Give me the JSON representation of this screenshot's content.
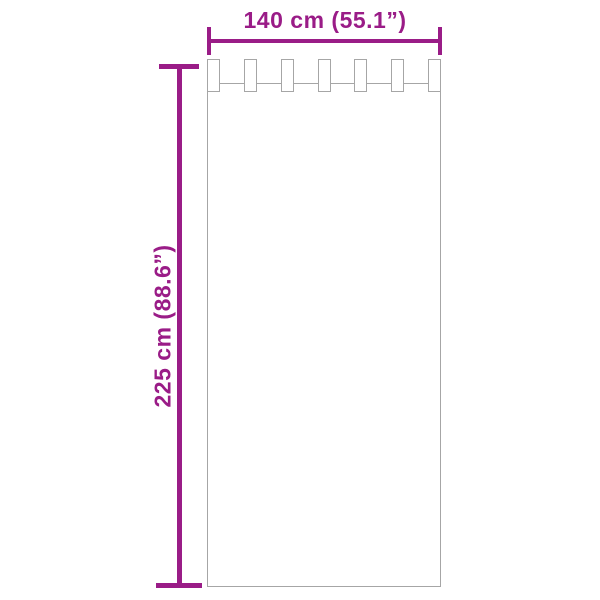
{
  "diagram": {
    "width_label": "140 cm (55.1”)",
    "height_label": "225 cm (88.6”)",
    "tab_count": 7,
    "colors": {
      "dimension": "#9A1C87",
      "outline": "#A6A6A6",
      "background": "#FFFFFF"
    }
  }
}
